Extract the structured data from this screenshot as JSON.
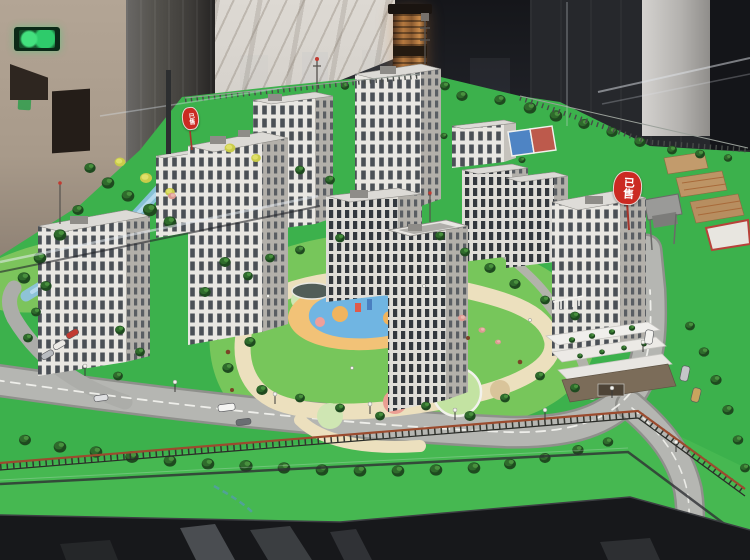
{
  "scene": {
    "subject": "residential-complex-architectural-scale-model-in-sales-gallery"
  },
  "signs": {
    "sold_left": "已售",
    "sold_right": "已售"
  },
  "icons": {
    "exit_sign": "running-man-exit-icon"
  },
  "palette": {
    "lawn_green": "#3cb14c",
    "apron_green": "#46b851",
    "courtyard_green": "#77c65b",
    "road_gray": "#b5b6b2",
    "building_face": "#e9e7e2",
    "building_side": "#b3b0aa",
    "marble": "#d8d4ce",
    "copper_fixture": "#a06a40",
    "sold_sign_red": "#cb2a22",
    "exit_sign_green": "#2ecb6b",
    "water_blue": "#8fc2e2",
    "playground_blue": "#70b5e2",
    "playground_orange": "#f2c277",
    "playground_pink": "#ef9f9a",
    "path_cream": "#ece0be",
    "table_dark": "#17181b"
  }
}
